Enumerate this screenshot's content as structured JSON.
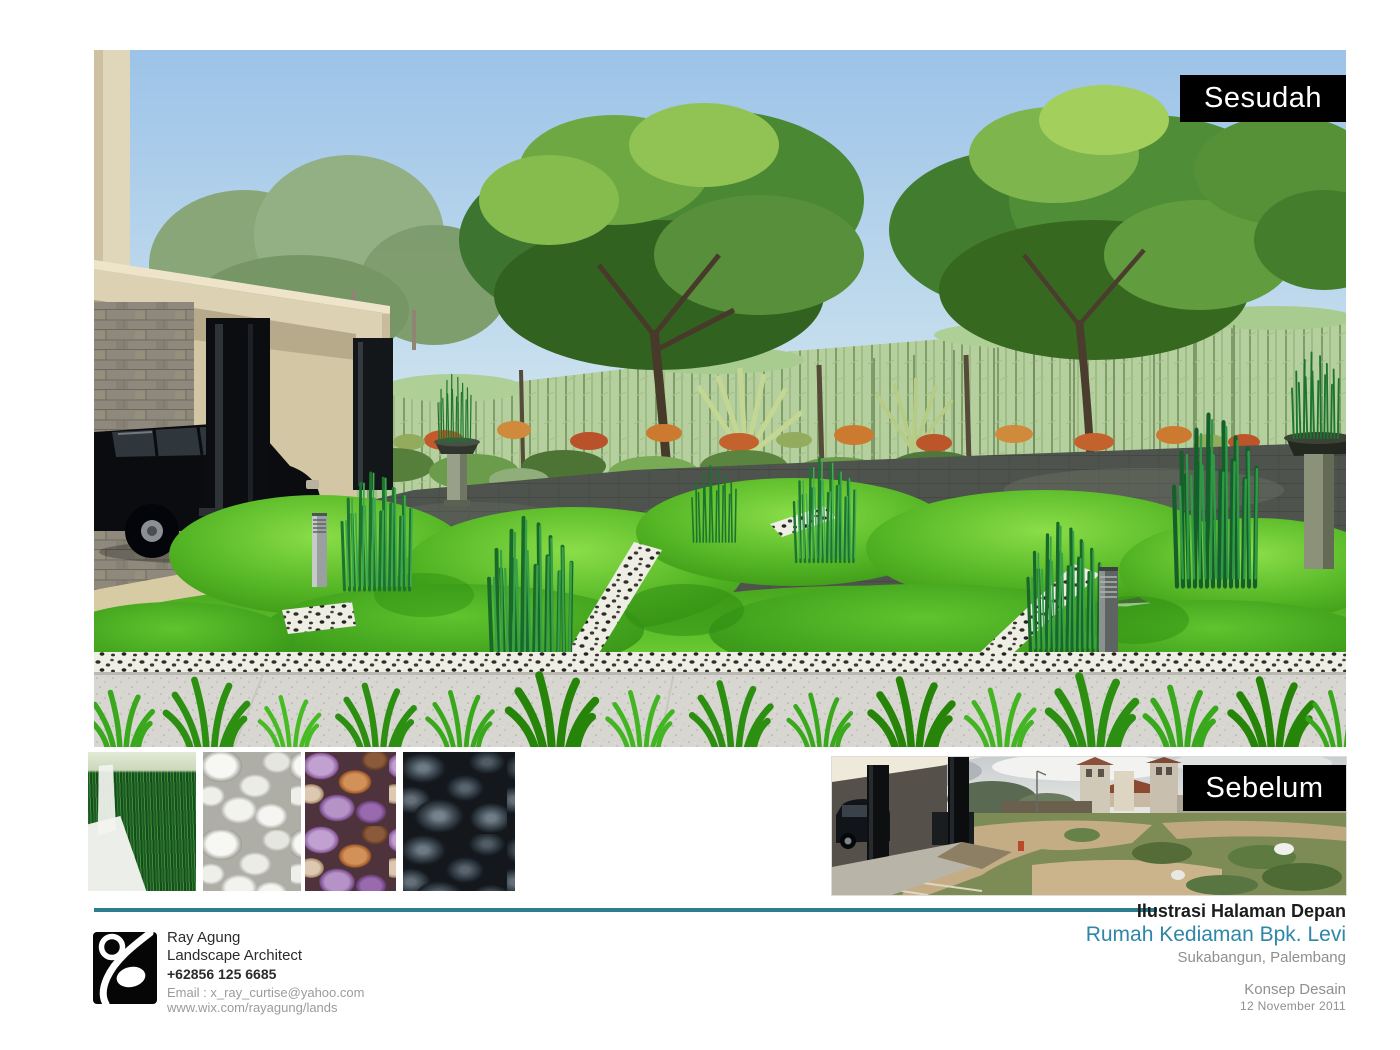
{
  "page": {
    "background": "#ffffff"
  },
  "after_panel": {
    "label": "Sesudah",
    "label_bg": "#000000",
    "label_color": "#ffffff"
  },
  "before_panel": {
    "label": "Sebelum",
    "label_bg": "#000000",
    "label_color": "#ffffff"
  },
  "materials": {
    "items": [
      {
        "name": "horsetail-reed-grass"
      },
      {
        "name": "white-pebbles"
      },
      {
        "name": "mixed-color-pebbles"
      },
      {
        "name": "black-polished-stones"
      }
    ]
  },
  "footer": {
    "accent_color": "#2e7d8f",
    "designer": {
      "name": "Ray Agung",
      "title": "Landscape Architect",
      "phone": "+62856  125 6685",
      "email": "Email : x_ray_curtise@yahoo.com",
      "website": "www.wix.com/rayagung/lands"
    },
    "project": {
      "title": "Ilustrasi Halaman Depan",
      "client": "Rumah Kediaman Bpk. Levi",
      "client_color": "#2e86a8",
      "location": "Sukabangun, Palembang",
      "phase": "Konsep Desain",
      "date": "12  November  2011"
    }
  }
}
